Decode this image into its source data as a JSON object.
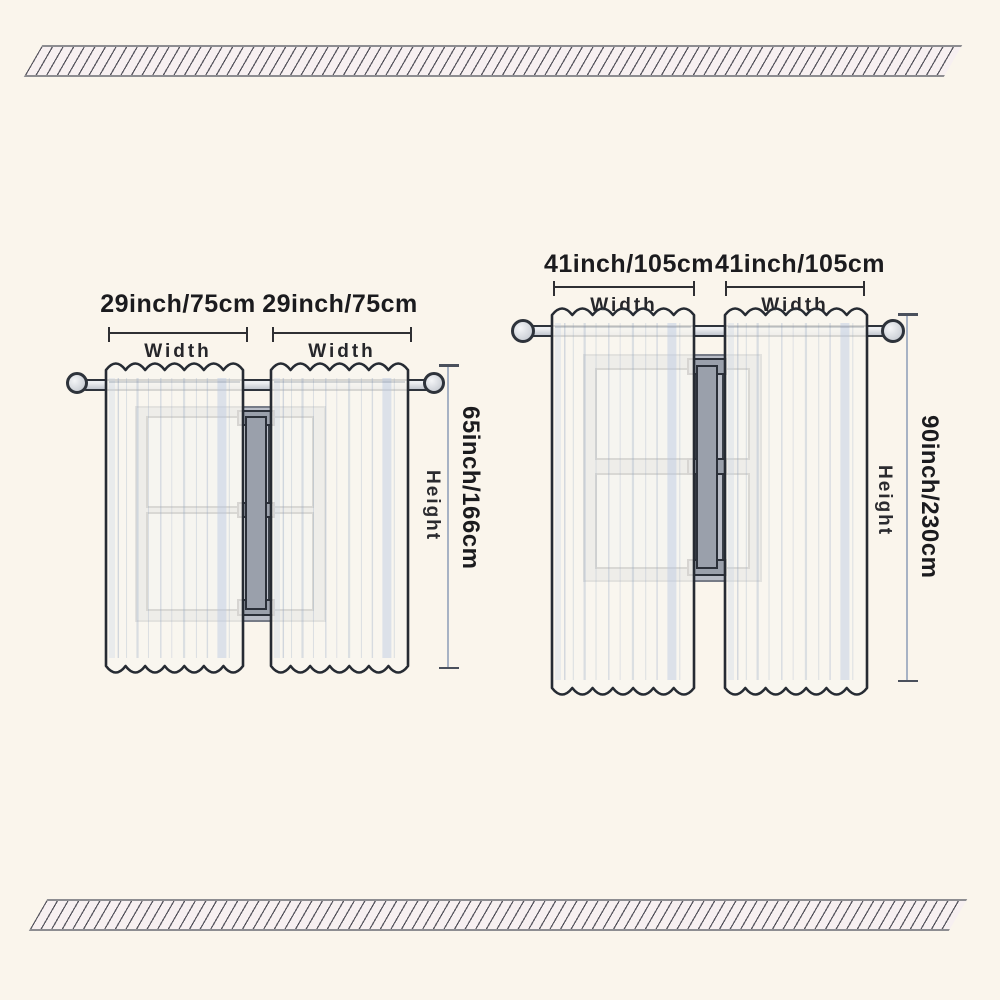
{
  "diagram_title": "curtain-size-diagram",
  "sets": {
    "small": {
      "panel1_width": "29inch/75cm",
      "panel2_width": "29inch/75cm",
      "width_label": "Width",
      "height_value": "65inch/166cm",
      "height_label": "Height"
    },
    "large": {
      "panel1_width": "41inch/105cm",
      "panel2_width": "41inch/105cm",
      "width_label": "Width",
      "height_value": "90inch/230cm",
      "height_label": "Height"
    }
  },
  "colors": {
    "background": "#faf5ec",
    "outline": "#262b33",
    "text": "#1b1b1e",
    "dimension_line": "#a7b2c4",
    "window_frame": "#b9bdc7",
    "hatch_band_fill": "#f7f0f1",
    "hatch_line": "#3a3a45",
    "curtain_fill": "#f8f6f0"
  }
}
